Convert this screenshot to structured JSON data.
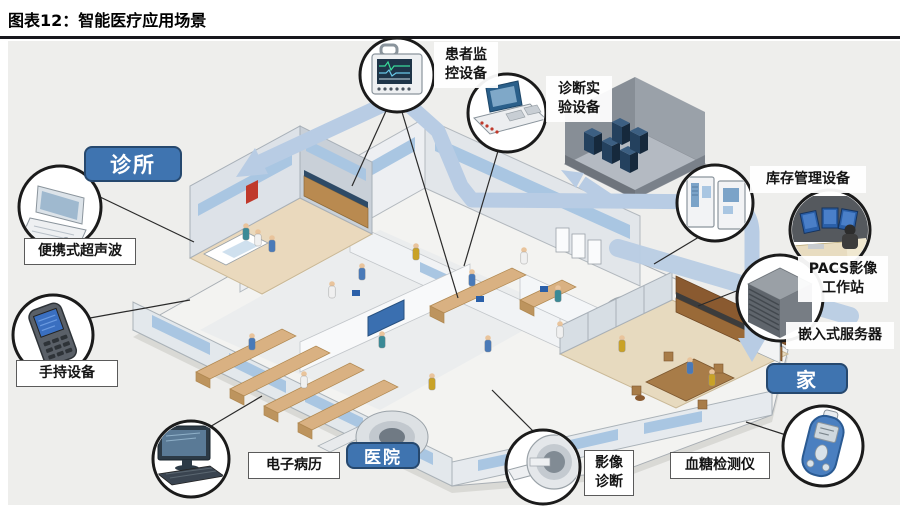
{
  "title": "图表12：智能医疗应用场景",
  "zones": {
    "clinic": "诊所",
    "hospital": "医院",
    "home": "家"
  },
  "devices": {
    "ultrasound": "便携式超声波",
    "handheld": "手持设备",
    "emr": "电子病历",
    "patient_monitor": "患者监控设备",
    "diagnostic_lab": "诊断实验设备",
    "inventory": "库存管理设备",
    "pacs": "PACS影像工作站",
    "embedded_server": "嵌入式服务器",
    "imaging": "影像诊断",
    "glucose": "血糖检测仪"
  },
  "colors": {
    "zone_tag": "#3f74b0",
    "zone_tag_border": "#26486e",
    "ribbon": "#b8cce4",
    "callout_border": "#1b1b1b",
    "canvas_background": "#eeeeec",
    "title_rule": "#17171c"
  }
}
